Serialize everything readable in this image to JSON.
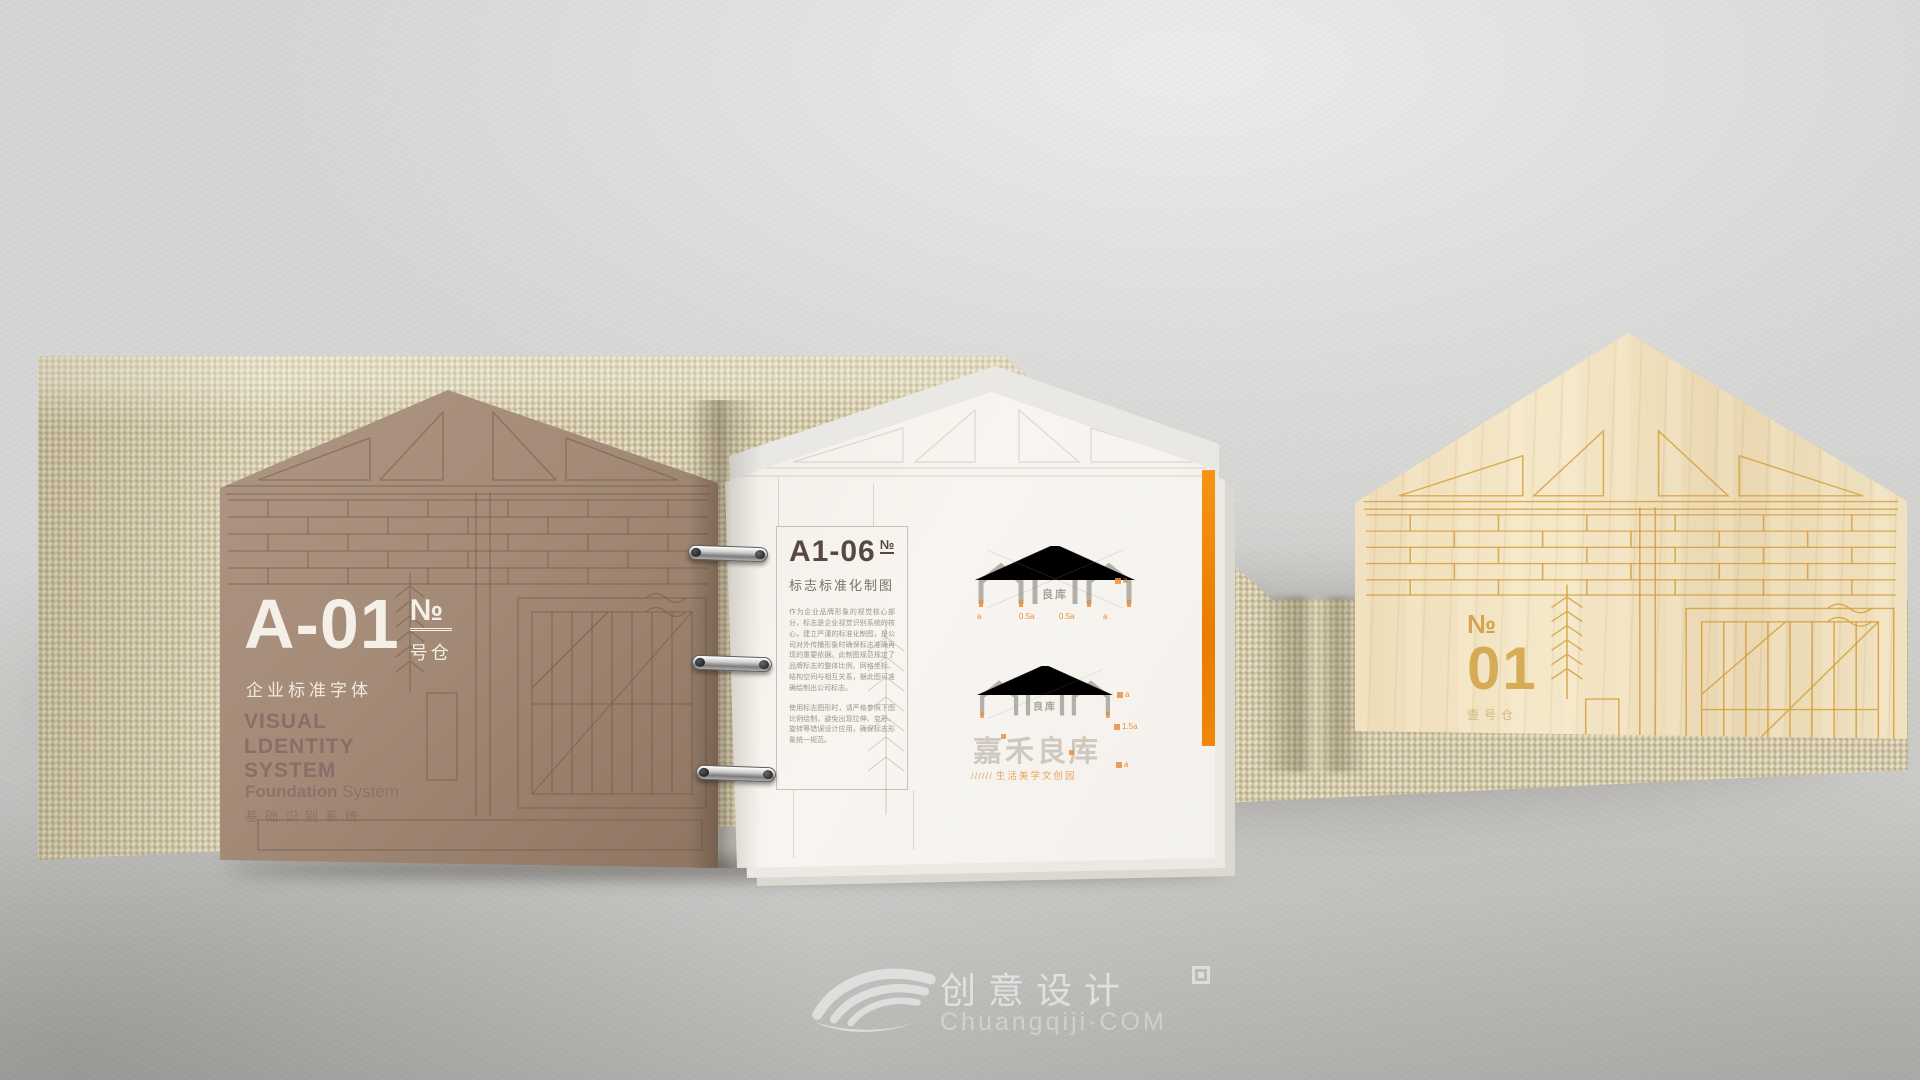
{
  "left_page": {
    "code": "A-01",
    "code_no": "№",
    "code_sub": "号仓",
    "font_label": "企业标准字体",
    "vis_lines": [
      "VISUAL",
      "LDENTITY",
      "SYSTEM"
    ],
    "foundation_bold": "Foundation",
    "foundation_rest": " System",
    "foundation_cn": "基础识别系统"
  },
  "right_page": {
    "code": "A1-06",
    "code_no": "№",
    "subtitle": "标志标准化制图",
    "paragraphs": [
      "作为企业品牌形象的视觉核心部分，标志是企业视觉识别系统的核心，建立严谨的标准化制图，是公司对外传播形象时确保标志准确再现的重要依据。此制图规范规定了品牌标志的整体比例、网格坐标、结构空间与相互关系，据此图可准确绘制出公司标志。",
      "使用标志图形时，请严格参照下图比例绘制，避免出现拉伸、变形、旋转等错误设计应用，确保标志形象统一规范。"
    ],
    "diagram1": {
      "mark_text": "良库",
      "dims_bottom": [
        "a",
        "0.5a",
        "0.5a",
        "a"
      ],
      "dim_right": "a"
    },
    "diagram2": {
      "mark_text": "良库",
      "brand": "嘉禾良库",
      "tagline_slashes": "//////",
      "tagline": "生活美学文创园",
      "dims_right": [
        "a",
        "1.5a",
        "a"
      ]
    }
  },
  "cover_panel": {
    "no_label": "№",
    "number": "01",
    "sub_label": "壹号仓"
  },
  "watermark": {
    "brand_cn": "创意设计",
    "brand_en": "Chuangqiji·COM"
  },
  "colors": {
    "accent_orange": "#ee8200",
    "dim_orange": "#e98f3f",
    "logo_gray": "#b3afa9",
    "brand_gray": "#cfc8bf",
    "page_brown": "#a48b78",
    "burlap": "#d2c7a2",
    "wood": "#eedcba",
    "gold_line": "#d2a546"
  }
}
